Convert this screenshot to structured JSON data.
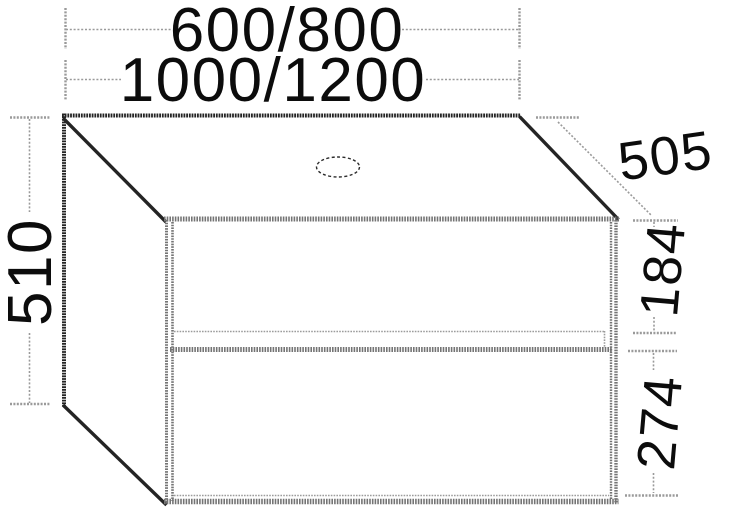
{
  "figure": {
    "kind": "furniture dimension drawing",
    "subject": "wall-mounted two-drawer washbasin vanity unit with tap-hole cut-out"
  },
  "labels": {
    "width_variants_top": "600/800",
    "width_variants_bottom": "1000/1200",
    "overall_height": "510",
    "depth": "505",
    "upper_drawer_height": "184",
    "lower_drawer_height": "274"
  },
  "colors": {
    "background": "#ffffff",
    "edge_dark": "#242424",
    "panel_edge_gray": "#747474",
    "dimension_gray": "#9a9a9a",
    "label_text": "#0c0c0c"
  }
}
